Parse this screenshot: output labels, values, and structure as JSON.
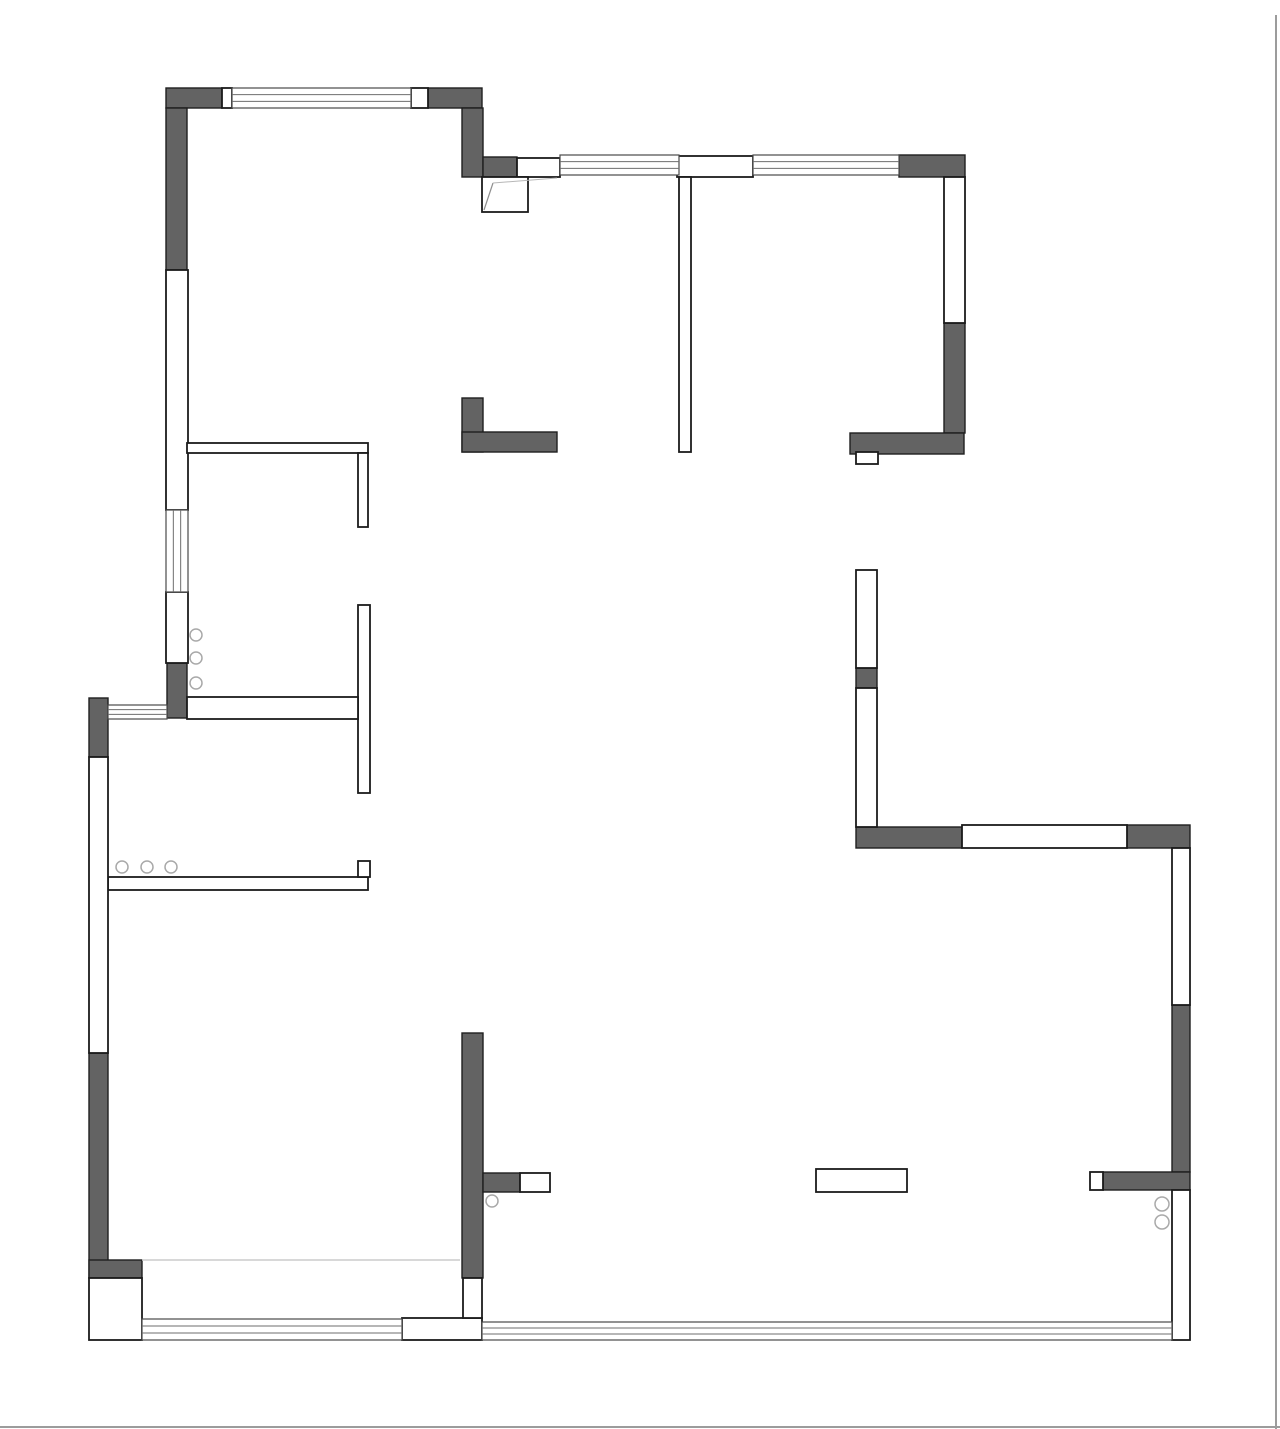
{
  "meta": {
    "canvas": {
      "width": 1280,
      "height": 1429
    },
    "colors": {
      "background": "#ffffff",
      "wall_dark_fill": "#636363",
      "wall_dark_stroke": "#1f1f1f",
      "partition_fill": "#ffffff",
      "partition_stroke": "#1b1b1b",
      "window_stroke": "#4a4a4a",
      "window_inner_stroke": "#6e6e6e",
      "fixture_stroke": "#a9a9a9",
      "door_leaf_stroke": "#8f8f8f",
      "door_swing_stroke": "#b7b7b7",
      "floor_line_stroke": "#cccccc",
      "page_edge_stroke": "#9c9c9c"
    }
  },
  "plan": {
    "structural_walls": [
      {
        "x": 166,
        "y": 88,
        "w": 56,
        "h": 20
      },
      {
        "x": 428,
        "y": 88,
        "w": 54,
        "h": 20
      },
      {
        "x": 166,
        "y": 108,
        "w": 21,
        "h": 162
      },
      {
        "x": 462,
        "y": 108,
        "w": 21,
        "h": 69
      },
      {
        "x": 483,
        "y": 157,
        "w": 34,
        "h": 20
      },
      {
        "x": 899,
        "y": 155,
        "w": 66,
        "h": 22
      },
      {
        "x": 944,
        "y": 323,
        "w": 21,
        "h": 110
      },
      {
        "x": 850,
        "y": 433,
        "w": 114,
        "h": 21
      },
      {
        "x": 462,
        "y": 398,
        "w": 21,
        "h": 54
      },
      {
        "x": 462,
        "y": 432,
        "w": 95,
        "h": 20
      },
      {
        "x": 167,
        "y": 663,
        "w": 20,
        "h": 55
      },
      {
        "x": 89,
        "y": 698,
        "w": 19,
        "h": 59
      },
      {
        "x": 856,
        "y": 668,
        "w": 21,
        "h": 20
      },
      {
        "x": 856,
        "y": 827,
        "w": 106,
        "h": 21
      },
      {
        "x": 1127,
        "y": 825,
        "w": 63,
        "h": 23
      },
      {
        "x": 1172,
        "y": 1005,
        "w": 18,
        "h": 167
      },
      {
        "x": 1103,
        "y": 1172,
        "w": 87,
        "h": 18
      },
      {
        "x": 89,
        "y": 1053,
        "w": 19,
        "h": 225
      },
      {
        "x": 89,
        "y": 1260,
        "w": 53,
        "h": 18
      },
      {
        "x": 462,
        "y": 1033,
        "w": 21,
        "h": 245
      },
      {
        "x": 483,
        "y": 1173,
        "w": 37,
        "h": 19
      }
    ],
    "partition_walls": [
      {
        "x": 222,
        "y": 88,
        "w": 10,
        "h": 20
      },
      {
        "x": 411,
        "y": 88,
        "w": 17,
        "h": 20
      },
      {
        "x": 166,
        "y": 270,
        "w": 22,
        "h": 240
      },
      {
        "x": 166,
        "y": 592,
        "w": 22,
        "h": 71
      },
      {
        "x": 517,
        "y": 158,
        "w": 43,
        "h": 19
      },
      {
        "x": 677,
        "y": 156,
        "w": 76,
        "h": 21
      },
      {
        "x": 679,
        "y": 177,
        "w": 12,
        "h": 275
      },
      {
        "x": 944,
        "y": 177,
        "w": 21,
        "h": 146
      },
      {
        "x": 856,
        "y": 452,
        "w": 22,
        "h": 12
      },
      {
        "x": 187,
        "y": 443,
        "w": 181,
        "h": 10
      },
      {
        "x": 358,
        "y": 453,
        "w": 10,
        "h": 74
      },
      {
        "x": 358,
        "y": 605,
        "w": 12,
        "h": 188
      },
      {
        "x": 187,
        "y": 697,
        "w": 171,
        "h": 22
      },
      {
        "x": 108,
        "y": 877,
        "w": 260,
        "h": 13
      },
      {
        "x": 358,
        "y": 861,
        "w": 12,
        "h": 16
      },
      {
        "x": 89,
        "y": 757,
        "w": 19,
        "h": 296
      },
      {
        "x": 856,
        "y": 570,
        "w": 21,
        "h": 98
      },
      {
        "x": 856,
        "y": 688,
        "w": 21,
        "h": 139
      },
      {
        "x": 962,
        "y": 825,
        "w": 165,
        "h": 23
      },
      {
        "x": 1172,
        "y": 848,
        "w": 18,
        "h": 157
      },
      {
        "x": 1172,
        "y": 1190,
        "w": 18,
        "h": 150
      },
      {
        "x": 520,
        "y": 1173,
        "w": 30,
        "h": 19
      },
      {
        "x": 89,
        "y": 1278,
        "w": 53,
        "h": 62
      },
      {
        "x": 402,
        "y": 1318,
        "w": 80,
        "h": 22
      },
      {
        "x": 463,
        "y": 1278,
        "w": 19,
        "h": 40
      },
      {
        "x": 816,
        "y": 1169,
        "w": 91,
        "h": 23
      },
      {
        "x": 1090,
        "y": 1172,
        "w": 13,
        "h": 18
      }
    ],
    "windows": [
      {
        "x": 232,
        "y": 88,
        "w": 179,
        "h": 20,
        "dir": "h"
      },
      {
        "x": 560,
        "y": 155,
        "w": 119,
        "h": 20,
        "dir": "h"
      },
      {
        "x": 753,
        "y": 155,
        "w": 146,
        "h": 20,
        "dir": "h"
      },
      {
        "x": 166,
        "y": 510,
        "w": 22,
        "h": 82,
        "dir": "v"
      },
      {
        "x": 108,
        "y": 705,
        "w": 59,
        "h": 14,
        "dir": "h"
      },
      {
        "x": 142,
        "y": 1319,
        "w": 260,
        "h": 21,
        "dir": "h"
      },
      {
        "x": 482,
        "y": 1322,
        "w": 690,
        "h": 18,
        "dir": "h"
      }
    ],
    "door": {
      "box": {
        "x": 482,
        "y": 177,
        "w": 46,
        "h": 35
      },
      "leaf": {
        "x1": 493,
        "y1": 183,
        "x2": 484,
        "y2": 210
      },
      "swing": {
        "x1": 493,
        "y1": 183,
        "x2": 557,
        "y2": 178
      }
    },
    "fixtures": [
      {
        "cx": 196,
        "cy": 635,
        "r": 6
      },
      {
        "cx": 196,
        "cy": 658,
        "r": 6
      },
      {
        "cx": 196,
        "cy": 683,
        "r": 6
      },
      {
        "cx": 122,
        "cy": 867,
        "r": 6
      },
      {
        "cx": 147,
        "cy": 867,
        "r": 6
      },
      {
        "cx": 171,
        "cy": 867,
        "r": 6
      },
      {
        "cx": 492,
        "cy": 1201,
        "r": 6
      },
      {
        "cx": 1162,
        "cy": 1204,
        "r": 7
      },
      {
        "cx": 1162,
        "cy": 1222,
        "r": 7
      }
    ],
    "floor_lines": [
      {
        "x1": 142,
        "y1": 1260,
        "x2": 460,
        "y2": 1260
      }
    ],
    "page_edges": [
      {
        "x1": 1276,
        "y1": 15,
        "x2": 1276,
        "y2": 1429
      },
      {
        "x1": 0,
        "y1": 1427,
        "x2": 1280,
        "y2": 1427
      }
    ]
  }
}
